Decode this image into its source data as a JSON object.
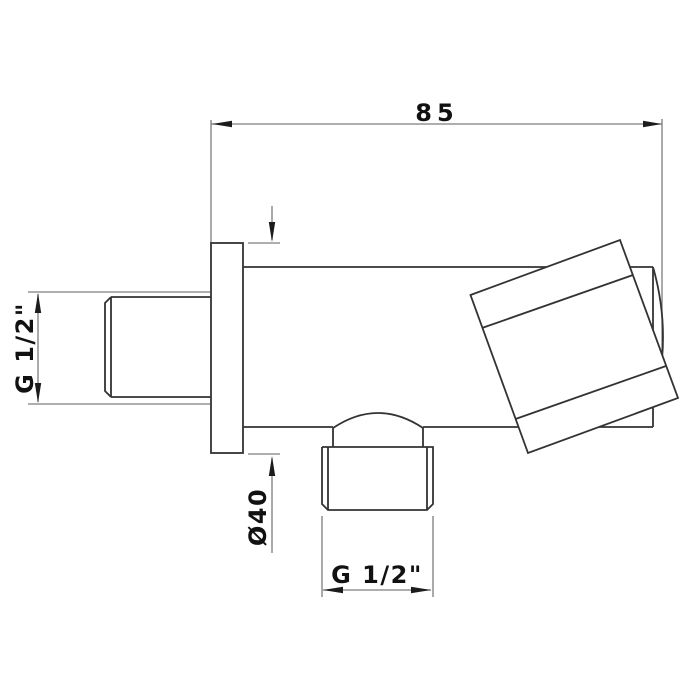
{
  "drawing": {
    "background_color": "#ffffff",
    "object_line_color": "#333333",
    "dimension_line_color": "#7d7d7d",
    "arrow_color": "#1c1c1c",
    "text_color": "#111111",
    "dimensions": {
      "top_width": "85",
      "inlet_thread": "G 1/2\"",
      "flange_diameter": "Ø40",
      "outlet_thread": "G 1/2\""
    }
  }
}
